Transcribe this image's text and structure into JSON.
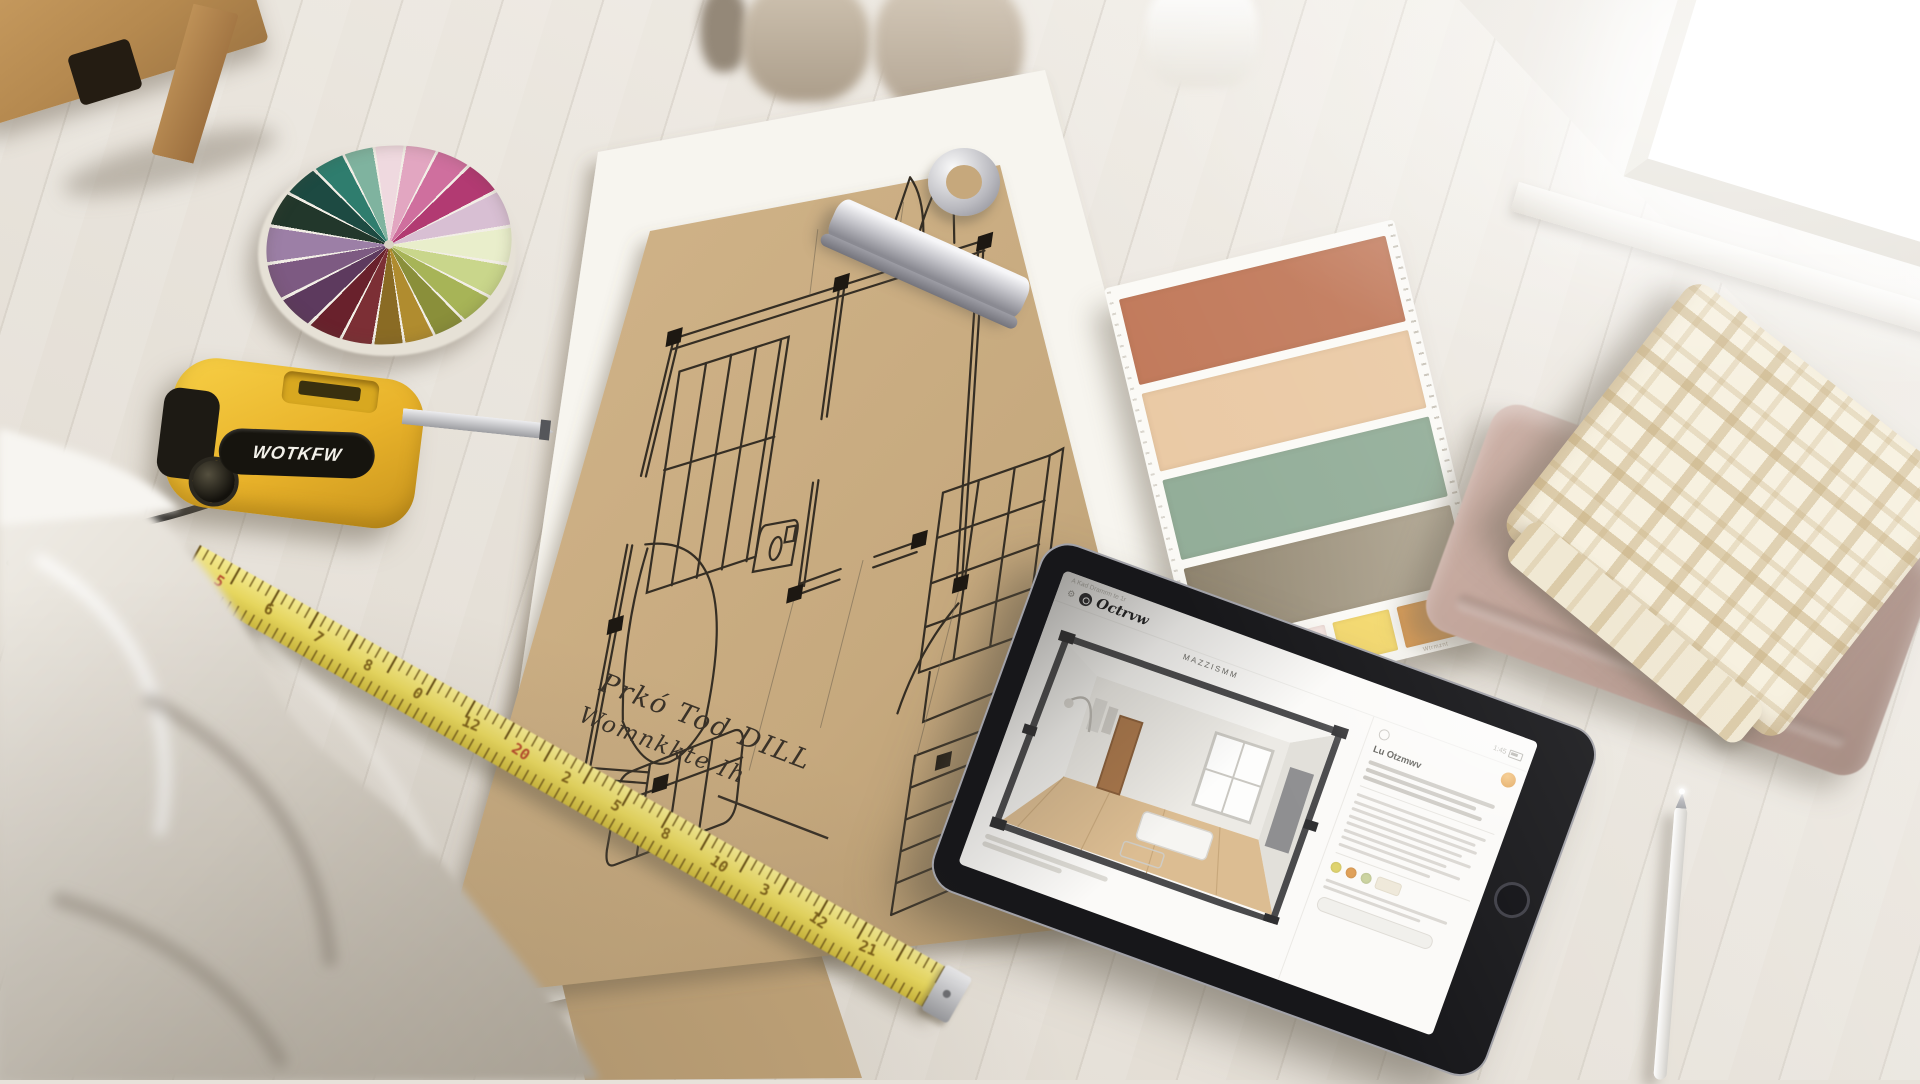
{
  "scene": {
    "title": "Interior design planning flat lay"
  },
  "tape_measure": {
    "brand_label": "WOTKFW"
  },
  "floor_plan": {
    "caption_line1": "Prkó Tod DILL",
    "caption_line2": "Womnkkte Ih"
  },
  "ruler": {
    "numbers": [
      "5",
      "6",
      "7",
      "8",
      "0",
      "12",
      "20",
      "2",
      "5",
      "8",
      "10",
      "3",
      "12",
      "21"
    ],
    "red_indices": [
      0,
      6
    ]
  },
  "color_wheel": {
    "segments": [
      "#efd9df",
      "#e2a6c1",
      "#cf6f9e",
      "#b23a72",
      "#d8bfd3",
      "#e9eecb",
      "#c9d68b",
      "#a7b457",
      "#8a8f3a",
      "#b08c2f",
      "#8a6b24",
      "#7c2f35",
      "#69212c",
      "#5d3a5e",
      "#7d5a82",
      "#9c7fa6",
      "#22372b",
      "#1d4a42",
      "#2f7d6e",
      "#7fb39f"
    ]
  },
  "palette_card": {
    "large_swatches": [
      {
        "name": "terracotta",
        "color": "#c1795a"
      },
      {
        "name": "peach",
        "color": "#eac9a4"
      },
      {
        "name": "sage-green",
        "color": "#92ad98"
      },
      {
        "name": "taupe",
        "color": "#8f846f",
        "color2": "#b3a995"
      }
    ],
    "small_swatches": [
      {
        "label": "Qwm",
        "color": "#c7d0d6"
      },
      {
        "label": "Opnri",
        "color": "#f7e7e3"
      },
      {
        "label": "I ut",
        "color": "#f4d96e"
      },
      {
        "label": "Wtrmznt",
        "color": "#dd9c52"
      }
    ]
  },
  "tablet": {
    "status_note": "A Kad Dramrm te 1r",
    "app_name": "Octrvw",
    "time": "1:45",
    "view_title": "Mazzismm",
    "accent": "#e09a3e",
    "panel": {
      "heading": "Lu Otzmwv",
      "chips": [
        "#dfd36e",
        "#e0a058",
        "#cbd3a0"
      ]
    }
  }
}
